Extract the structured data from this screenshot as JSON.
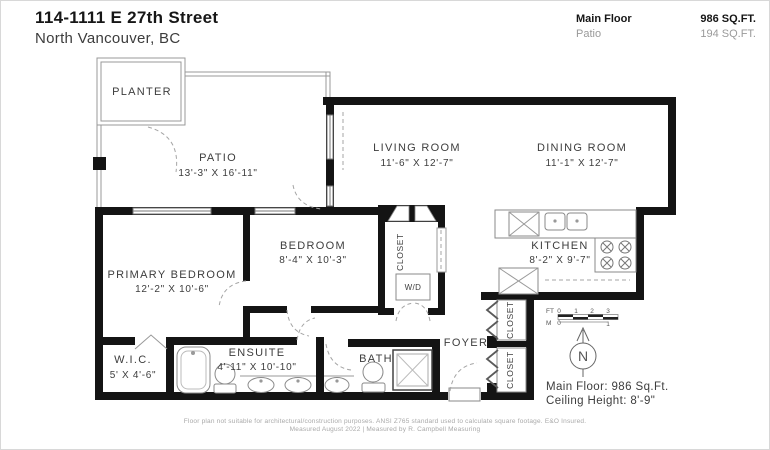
{
  "header": {
    "title": "114-1111 E 27th Street",
    "subtitle": "North Vancouver, BC",
    "area_rows": [
      {
        "label": "Main Floor",
        "value": "986 SQ.FT."
      },
      {
        "label": "Patio",
        "value": "194 SQ.FT."
      }
    ]
  },
  "rooms": {
    "planter": {
      "name": "PLANTER"
    },
    "patio": {
      "name": "PATIO",
      "dims": "13'-3\" X 16'-11\""
    },
    "living": {
      "name": "LIVING ROOM",
      "dims": "11'-6\" X 12'-7\""
    },
    "dining": {
      "name": "DINING ROOM",
      "dims": "11'-1\" X 12'-7\""
    },
    "kitchen": {
      "name": "KITCHEN",
      "dims": "8'-2\" X 9'-7\""
    },
    "bedroom": {
      "name": "BEDROOM",
      "dims": "8'-4\" X 10'-3\""
    },
    "primary": {
      "name": "PRIMARY BEDROOM",
      "dims": "12'-2\" X 10'-6\""
    },
    "wic": {
      "name": "W.I.C.",
      "dims": "5' X 4'-6\""
    },
    "ensuite": {
      "name": "ENSUITE",
      "dims": "4'-11\" X 10'-10\""
    },
    "bath": {
      "name": "BATH"
    },
    "foyer": {
      "name": "FOYER"
    }
  },
  "labels": {
    "closet": "CLOSET",
    "wd": "W/D"
  },
  "scale_bar": {
    "ft": "FT",
    "m": "M",
    "ft_ticks": [
      "0",
      "1",
      "2",
      "3"
    ],
    "m_ticks": [
      "0",
      "1"
    ]
  },
  "compass": {
    "north": "N"
  },
  "summary": {
    "area": "Main Floor: 986 Sq.Ft.",
    "ceiling": "Ceiling Height: 8'-9\""
  },
  "footer": {
    "line1": "Floor plan not suitable for architectural/construction purposes. ANSI Z765 standard used to calculate square footage. E&O Insured.",
    "line2": "Measured August 2022 | Measured by R. Campbell Measuring"
  },
  "colors": {
    "wall": "#141414",
    "thin_line": "#999999",
    "label_text": "#3d3d3d",
    "muted_text": "#9a9a9a"
  }
}
